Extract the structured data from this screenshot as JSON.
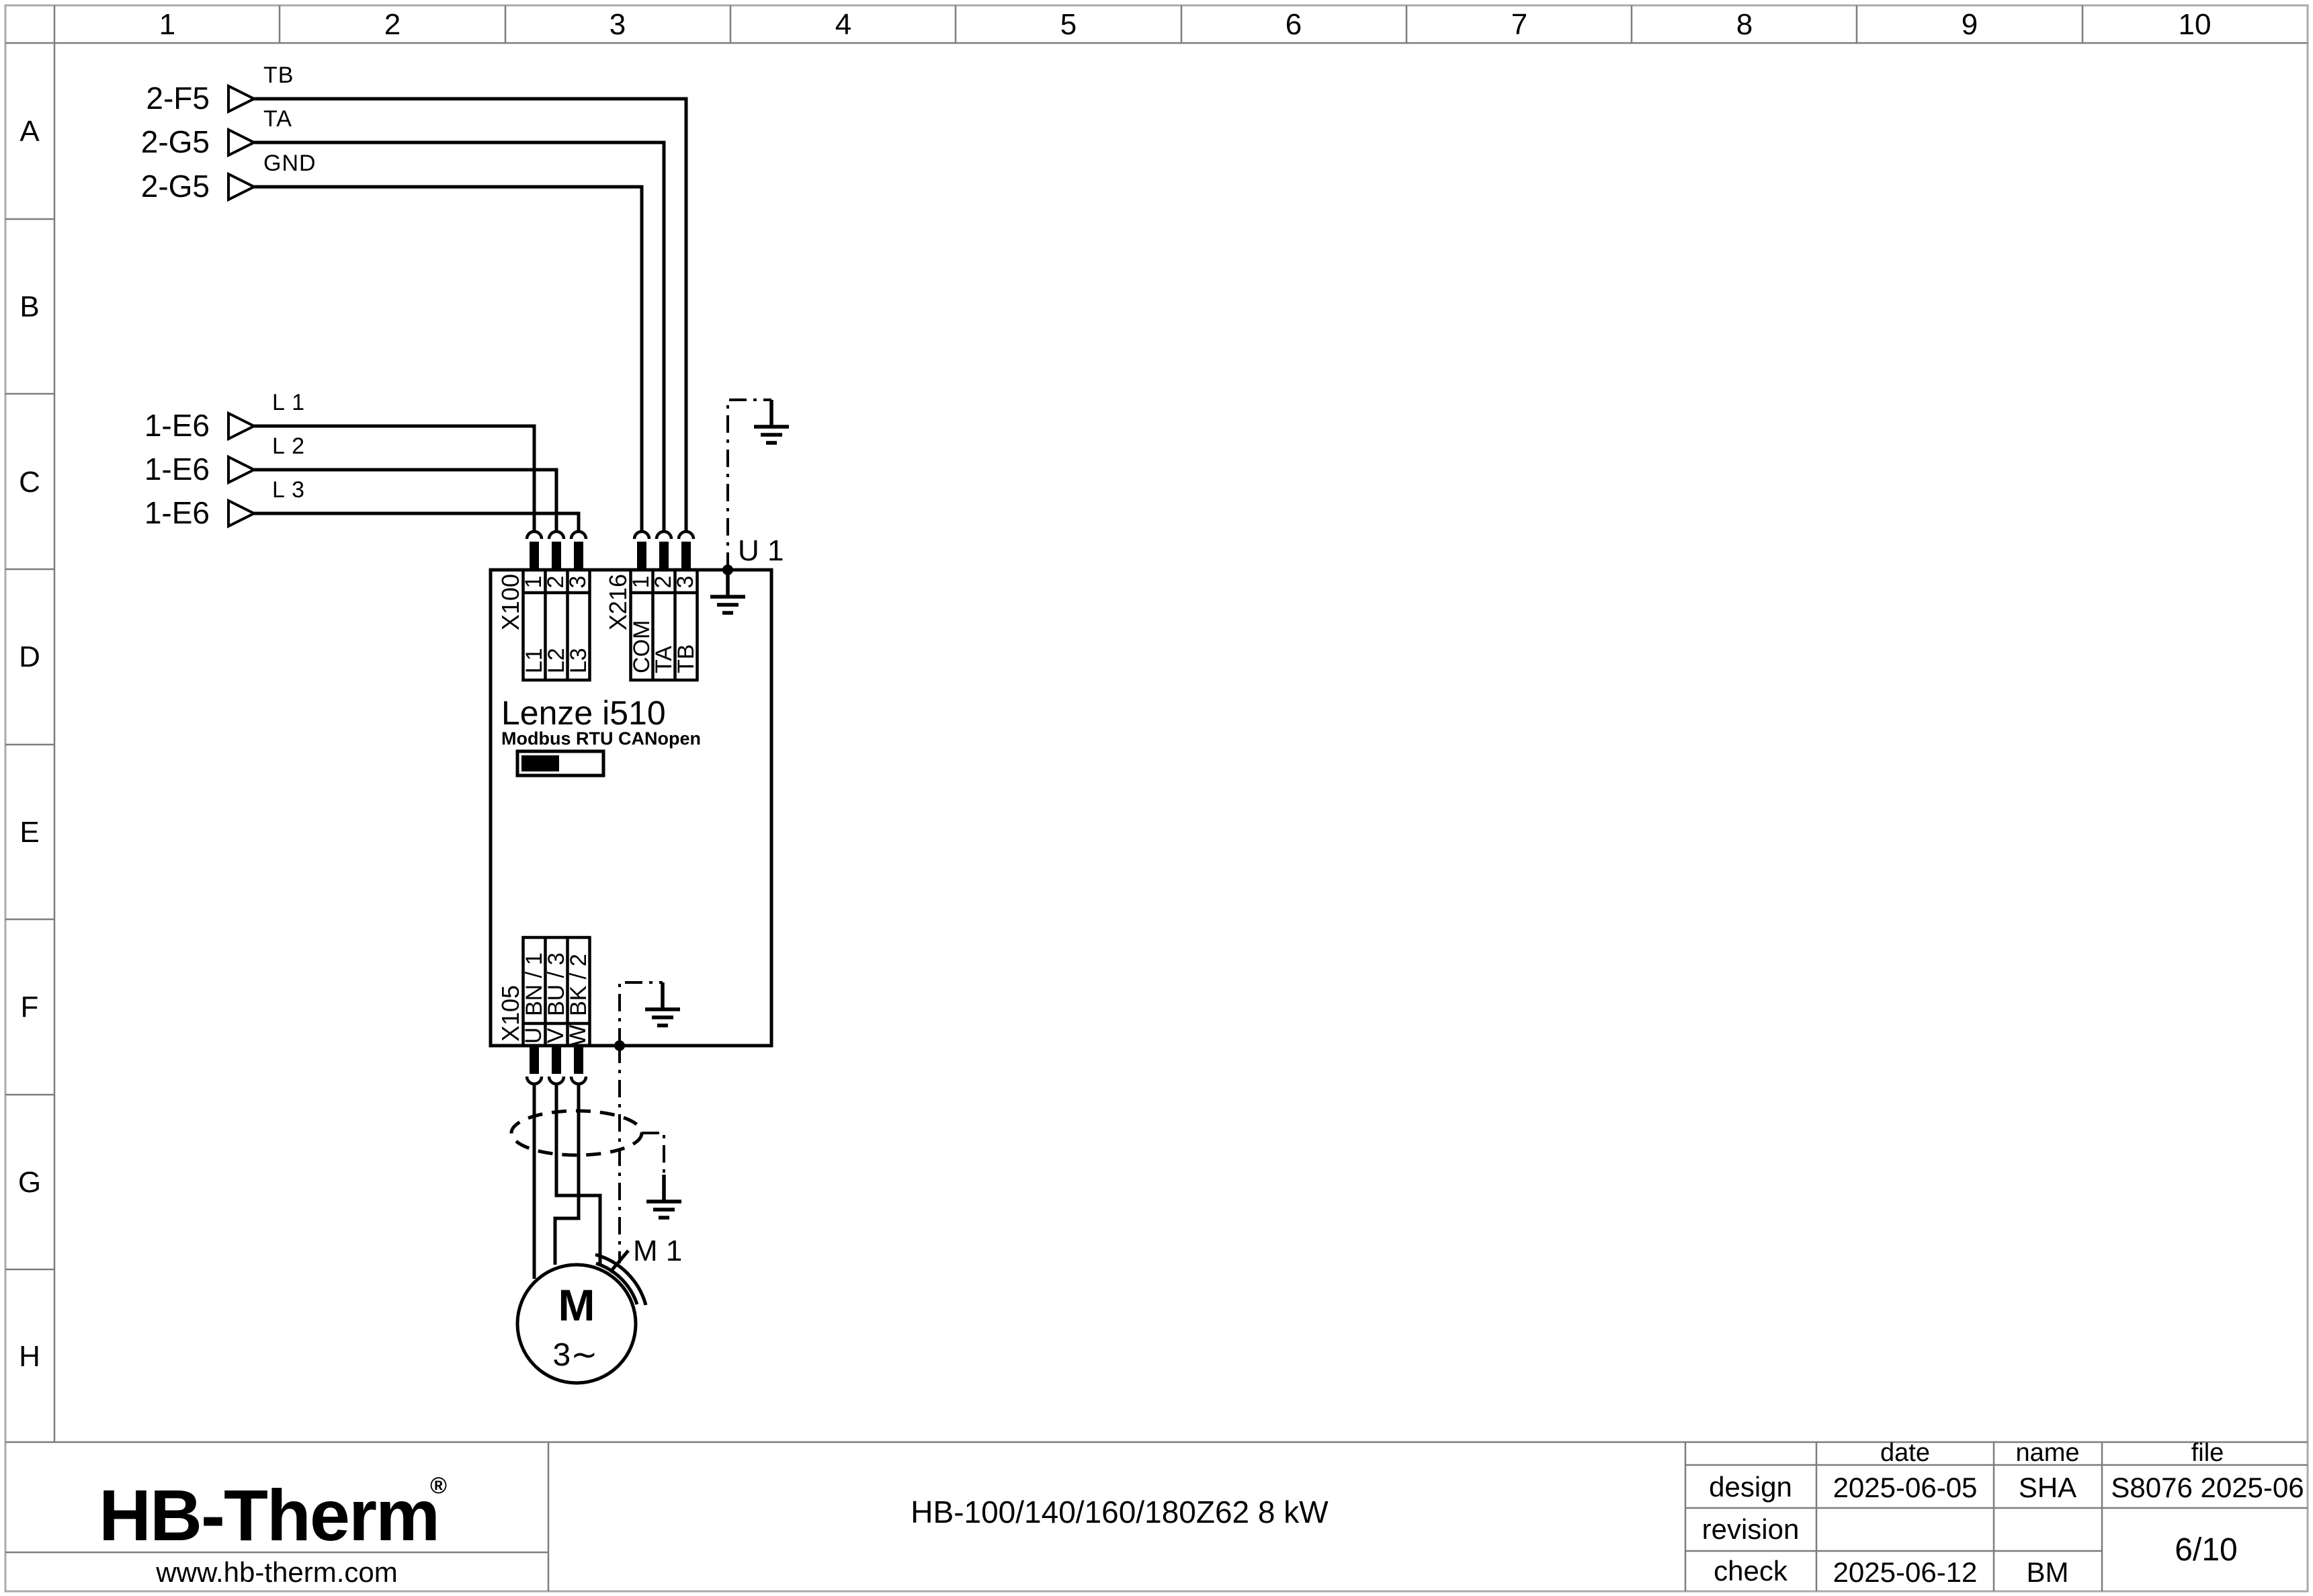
{
  "colors": {
    "brand_navy": "#17264d",
    "line_black": "#000000",
    "frame_gray": "#7d7d7d"
  },
  "ruler": {
    "cols": [
      "1",
      "2",
      "3",
      "4",
      "5",
      "6",
      "7",
      "8",
      "9",
      "10"
    ],
    "rows": [
      "A",
      "B",
      "C",
      "D",
      "E",
      "F",
      "G",
      "H"
    ]
  },
  "references": [
    {
      "tag": "2-F5",
      "signal": "TB"
    },
    {
      "tag": "2-G5",
      "signal": "TA"
    },
    {
      "tag": "2-G5",
      "signal": "GND"
    },
    {
      "tag": "1-E6",
      "signal": "L 1"
    },
    {
      "tag": "1-E6",
      "signal": "L 2"
    },
    {
      "tag": "1-E6",
      "signal": "L 3"
    }
  ],
  "device": {
    "designator": "U 1",
    "name": "Lenze i510",
    "subtitle": "Modbus RTU CANopen"
  },
  "terminal_blocks": {
    "x100": {
      "name": "X100",
      "pins": [
        "1",
        "2",
        "3"
      ],
      "signals": [
        "L1",
        "L2",
        "L3"
      ]
    },
    "x216": {
      "name": "X216",
      "pins": [
        "1",
        "2",
        "3"
      ],
      "signals": [
        "COM",
        "TA",
        "TB"
      ]
    },
    "x105": {
      "name": "X105",
      "pins": [
        "U",
        "V",
        "W"
      ],
      "signals": [
        "BN / 1",
        "BU / 3",
        "BK / 2"
      ]
    }
  },
  "motor": {
    "designator": "M 1",
    "symbol": "M",
    "phases": "3∼"
  },
  "title_block": {
    "logo": "HB-Therm",
    "logo_reg": "®",
    "website": "www.hb-therm.com",
    "product": "HB-100/140/160/180Z62 8 kW",
    "headers": {
      "date": "date",
      "name": "name",
      "file": "file"
    },
    "rows": [
      {
        "label": "design",
        "date": "2025-06-05",
        "name": "SHA",
        "file": "S8076 2025-06"
      },
      {
        "label": "revision",
        "date": "",
        "name": "",
        "file": ""
      },
      {
        "label": "check",
        "date": "2025-06-12",
        "name": "BM",
        "file": ""
      }
    ],
    "page": "6/10"
  }
}
